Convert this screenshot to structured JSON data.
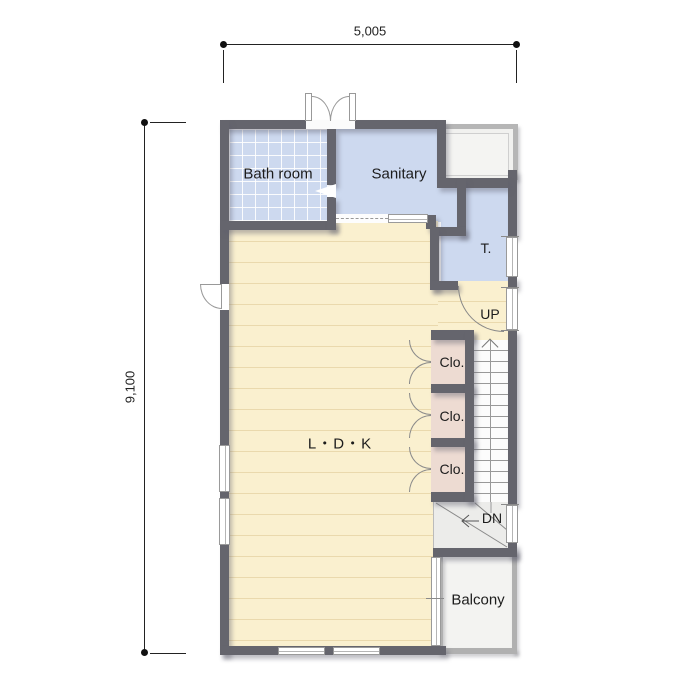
{
  "page": {
    "type": "floor-plan"
  },
  "dimensions": {
    "width_label": "5,005",
    "height_label": "9,100"
  },
  "rooms": {
    "bathroom": {
      "label": "Bath room",
      "color": "#cdd9ef"
    },
    "sanitary": {
      "label": "Sanitary",
      "color": "#cdd9ef"
    },
    "toilet": {
      "label": "T.",
      "color": "#cdd9ef"
    },
    "ldk": {
      "label": "L・D・K",
      "color": "#faf0cf"
    },
    "balcony": {
      "label": "Balcony",
      "color": "#f3f3f1"
    },
    "closets": [
      {
        "label": "Clo."
      },
      {
        "label": "Clo."
      },
      {
        "label": "Clo."
      }
    ]
  },
  "stairs": {
    "up_label": "UP",
    "down_label": "DN"
  },
  "colors": {
    "wall": "#65656d",
    "closet_floor": "#eddbd2",
    "silver_trim": "#b0b0b0",
    "dimension_text": "#222222"
  }
}
